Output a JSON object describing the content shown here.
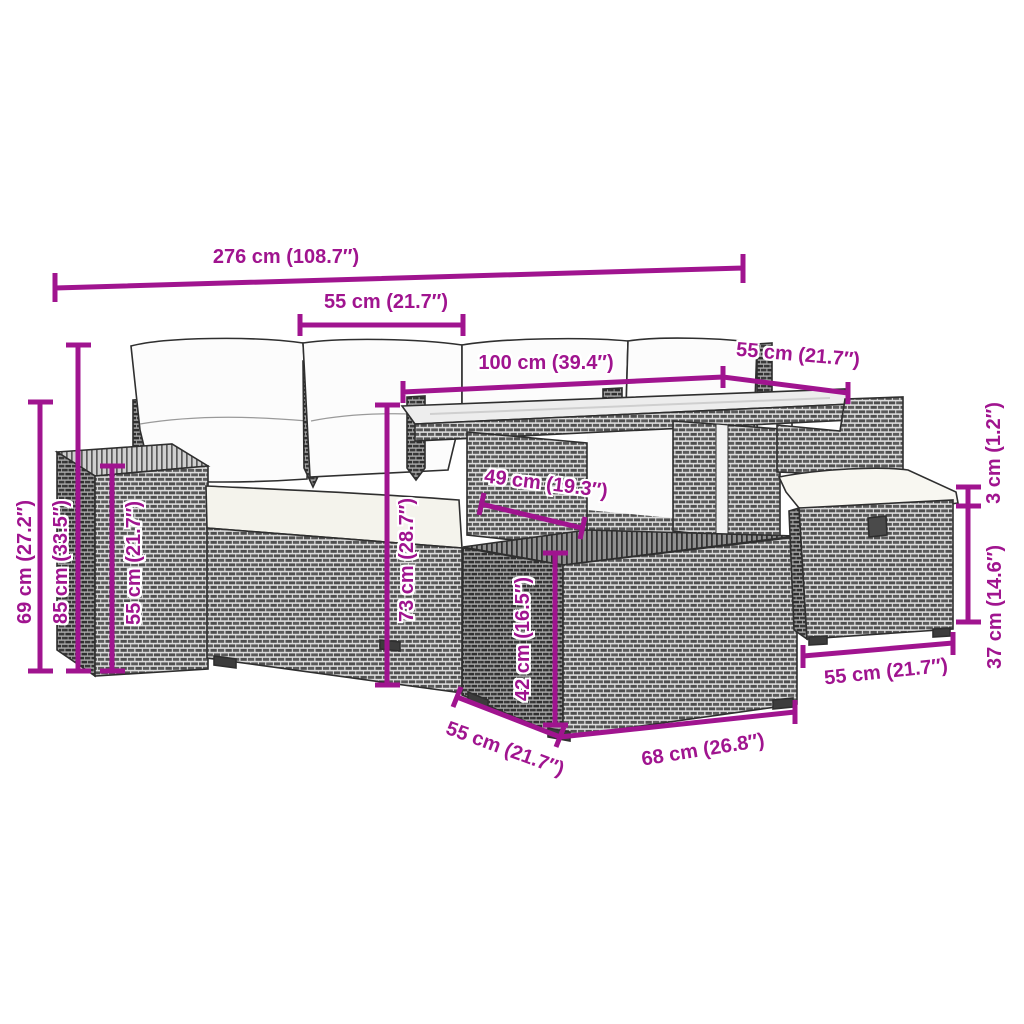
{
  "diagram": {
    "type": "product-dimension-diagram",
    "product": "garden lounge set (rattan sofa, glass-top table, ottoman, stool) with cushions",
    "background_color": "#ffffff",
    "accent_color": "#A0148F",
    "rattan_color": "#8a8a8a",
    "cushion_color": "#f4f3ec",
    "dimensions": {
      "top_total": "276 cm (108.7″)",
      "top_left_seat": "55 cm (21.7″)",
      "top_table": "100 cm (39.4″)",
      "top_right_seat": "55 cm (21.7″)",
      "arm_height": "69 cm (27.2″)",
      "total_height": "85 cm (33.5″)",
      "seat_height": "55 cm (21.7″)",
      "table_height": "73 cm (28.7″)",
      "table_clearance": "49 cm (19.3″)",
      "ottoman_height": "42 cm (16.5″)",
      "cushion_thickness": "3 cm (1.2″)",
      "stool_height": "37 cm (14.6″)",
      "ottoman_depth": "55 cm (21.7″)",
      "ottoman_width": "68 cm (26.8″)",
      "stool_width": "55 cm (21.7″)"
    }
  }
}
